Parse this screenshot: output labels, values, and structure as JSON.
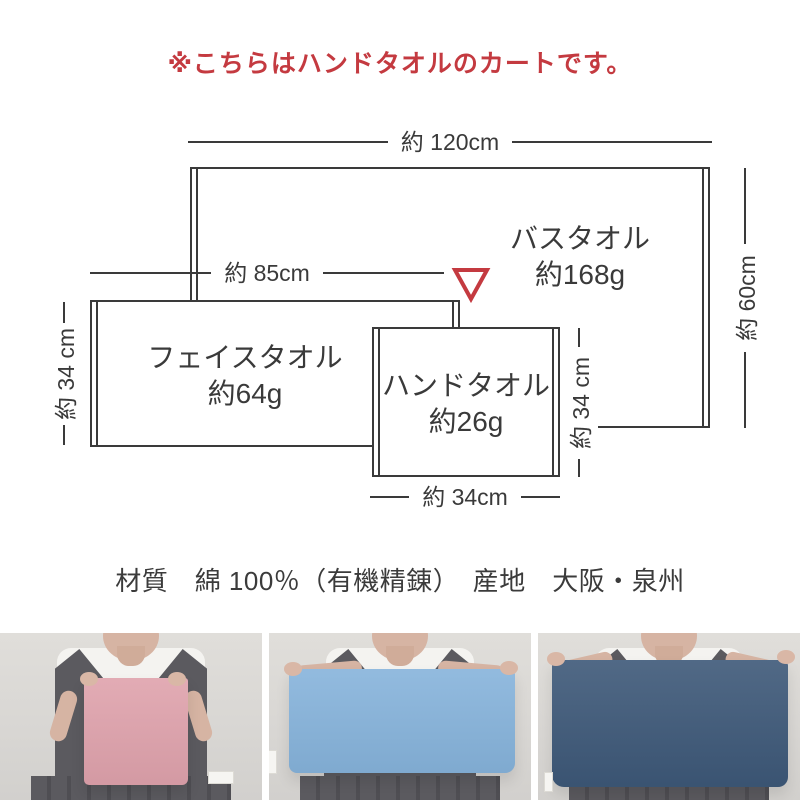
{
  "notice": {
    "text": "※こちらはハンドタオルのカートです。"
  },
  "diagram": {
    "bath": {
      "name": "バスタオル",
      "weight": "約168g",
      "width_label": "約 120cm",
      "height_label": "約 60cm"
    },
    "face": {
      "name": "フェイスタオル",
      "weight": "約64g",
      "width_label": "約 85cm",
      "height_label": "約 34 cm"
    },
    "hand": {
      "name": "ハンドタオル",
      "weight": "約26g",
      "width_label": "約 34cm",
      "height_label": "約 34 cm"
    },
    "pointer": {
      "icon": "red-triangle-down",
      "color": "#c43a40"
    }
  },
  "specs": {
    "text": "材質　綿 100％（有機精錬）　産地　大阪・泉州"
  },
  "style_colors": {
    "accent_red": "#c43a40",
    "diagram_line": "#3a3a3a",
    "towel_hand_pink": "#dfa2ac",
    "towel_face_blue": "#86b3db",
    "towel_bath_navy": "#3d5878"
  },
  "photos": [
    {
      "id": "hand-towel-photo",
      "towel_color": "#dfa2ac"
    },
    {
      "id": "face-towel-photo",
      "towel_color": "#86b3db"
    },
    {
      "id": "bath-towel-photo",
      "towel_color": "#3d5878"
    }
  ]
}
